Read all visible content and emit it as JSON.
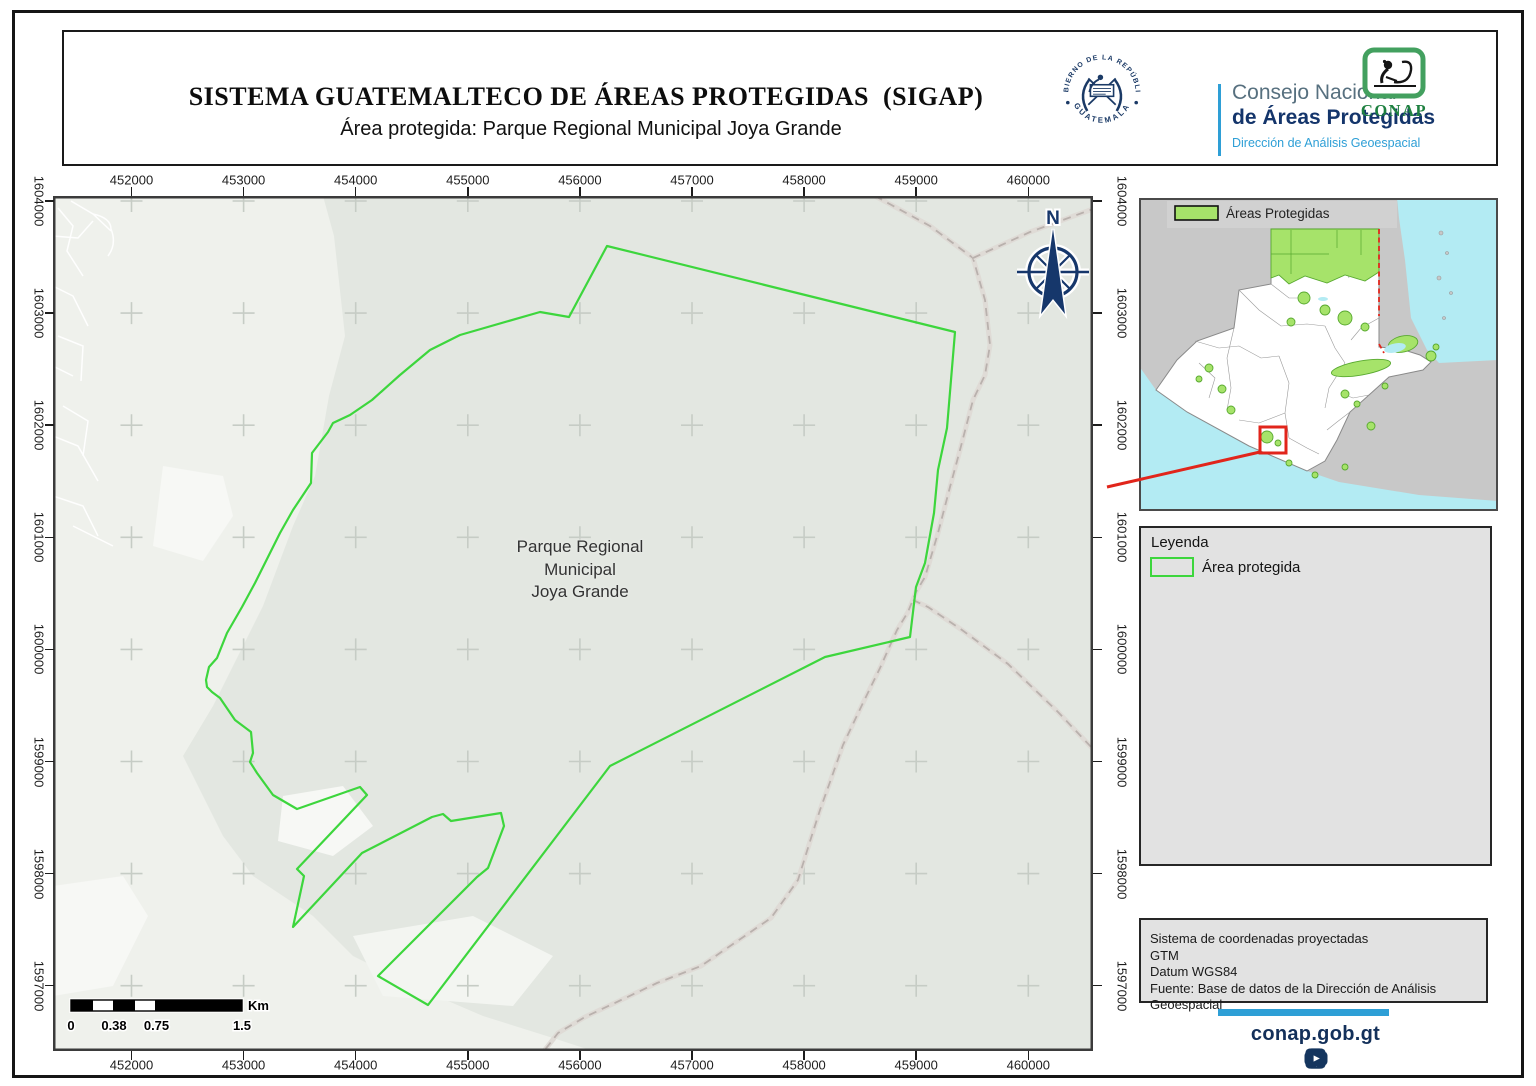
{
  "header": {
    "title": "SISTEMA GUATEMALTECO DE ÁREAS PROTEGIDAS  (SIGAP)",
    "subtitle": "Área protegida: Parque Regional Municipal Joya Grande",
    "seal": {
      "arc_top": "GOBIERNO DE LA REPÚBLICA",
      "arc_bottom": "GUATEMALA"
    },
    "org": {
      "line1": "Consejo Nacional",
      "line2": "de Áreas Protegidas",
      "line3": "Dirección de Análisis Geoespacial"
    },
    "conap": "CONAP"
  },
  "map": {
    "x_ticks": [
      "452000",
      "453000",
      "454000",
      "455000",
      "456000",
      "457000",
      "458000",
      "459000",
      "460000"
    ],
    "y_ticks": [
      "1604000",
      "1603000",
      "1602000",
      "1601000",
      "1600000",
      "1599000",
      "1598000",
      "1597000"
    ],
    "area_label": [
      "Parque Regional",
      "Municipal",
      "Joya Grande"
    ],
    "north_label": "N",
    "scalebar": {
      "labels": [
        "0",
        "0.38",
        "0.75",
        "1.5"
      ],
      "unit": "Km"
    },
    "colors": {
      "boundary": "#3dd63d",
      "grid_cross": "#c6ccc5",
      "road": "#b9b1ad",
      "road_casing": "#dfdbd6"
    },
    "boundary_px": [
      [
        607,
        246
      ],
      [
        955,
        332
      ],
      [
        947,
        428
      ],
      [
        938,
        470
      ],
      [
        934,
        513
      ],
      [
        925,
        563
      ],
      [
        916,
        587
      ],
      [
        910,
        637
      ],
      [
        825,
        657
      ],
      [
        610,
        766
      ],
      [
        428,
        1005
      ],
      [
        378,
        976
      ],
      [
        477,
        877
      ],
      [
        488,
        868
      ],
      [
        504,
        826
      ],
      [
        501,
        813
      ],
      [
        451,
        821
      ],
      [
        443,
        814
      ],
      [
        432,
        817
      ],
      [
        362,
        853
      ],
      [
        293,
        927
      ],
      [
        304,
        876
      ],
      [
        297,
        869
      ],
      [
        367,
        795
      ],
      [
        360,
        787
      ],
      [
        297,
        809
      ],
      [
        273,
        795
      ],
      [
        257,
        773
      ],
      [
        250,
        762
      ],
      [
        253,
        753
      ],
      [
        251,
        732
      ],
      [
        235,
        720
      ],
      [
        220,
        698
      ],
      [
        212,
        692
      ],
      [
        207,
        687
      ],
      [
        206,
        680
      ],
      [
        209,
        667
      ],
      [
        217,
        658
      ],
      [
        227,
        633
      ],
      [
        242,
        607
      ],
      [
        255,
        583
      ],
      [
        280,
        533
      ],
      [
        293,
        510
      ],
      [
        311,
        483
      ],
      [
        312,
        453
      ],
      [
        328,
        432
      ],
      [
        333,
        423
      ],
      [
        350,
        415
      ],
      [
        372,
        400
      ],
      [
        400,
        375
      ],
      [
        430,
        350
      ],
      [
        460,
        335
      ],
      [
        540,
        312
      ],
      [
        569,
        317
      ]
    ],
    "roads_px": {
      "main": [
        [
          875,
          196
        ],
        [
          930,
          226
        ],
        [
          973,
          258
        ],
        [
          985,
          300
        ],
        [
          990,
          345
        ],
        [
          985,
          375
        ],
        [
          973,
          400
        ],
        [
          960,
          450
        ],
        [
          950,
          487
        ],
        [
          938,
          533
        ],
        [
          925,
          577
        ],
        [
          916,
          592
        ],
        [
          908,
          612
        ],
        [
          897,
          630
        ],
        [
          880,
          668
        ],
        [
          862,
          705
        ],
        [
          843,
          745
        ],
        [
          830,
          782
        ],
        [
          820,
          810
        ],
        [
          812,
          835
        ],
        [
          798,
          880
        ],
        [
          786,
          897
        ],
        [
          771,
          918
        ],
        [
          736,
          942
        ],
        [
          701,
          966
        ],
        [
          657,
          983
        ],
        [
          619,
          1001
        ],
        [
          585,
          1017
        ],
        [
          558,
          1033
        ],
        [
          544,
          1051
        ]
      ],
      "south_east": [
        [
          913,
          600
        ],
        [
          928,
          607
        ],
        [
          962,
          630
        ],
        [
          1008,
          664
        ],
        [
          1058,
          712
        ],
        [
          1093,
          749
        ]
      ],
      "north_east": [
        [
          973,
          258
        ],
        [
          1030,
          232
        ],
        [
          1082,
          213
        ],
        [
          1093,
          209
        ]
      ]
    }
  },
  "inset": {
    "legend_label": "Áreas Protegidas",
    "colors": {
      "protected": "#a6e36a",
      "water": "#b3ebf3",
      "neighbor": "#c8c8c8",
      "highlight": "#e1251b"
    }
  },
  "legend": {
    "title": "Leyenda",
    "item_label": "Área protegida"
  },
  "info": {
    "lines": [
      "Sistema de coordenadas proyectadas",
      "GTM",
      "Datum WGS84",
      "Fuente: Base de datos de la Dirección de Análisis Geoespacial"
    ]
  },
  "footer": {
    "site": "conap.gob.gt"
  }
}
